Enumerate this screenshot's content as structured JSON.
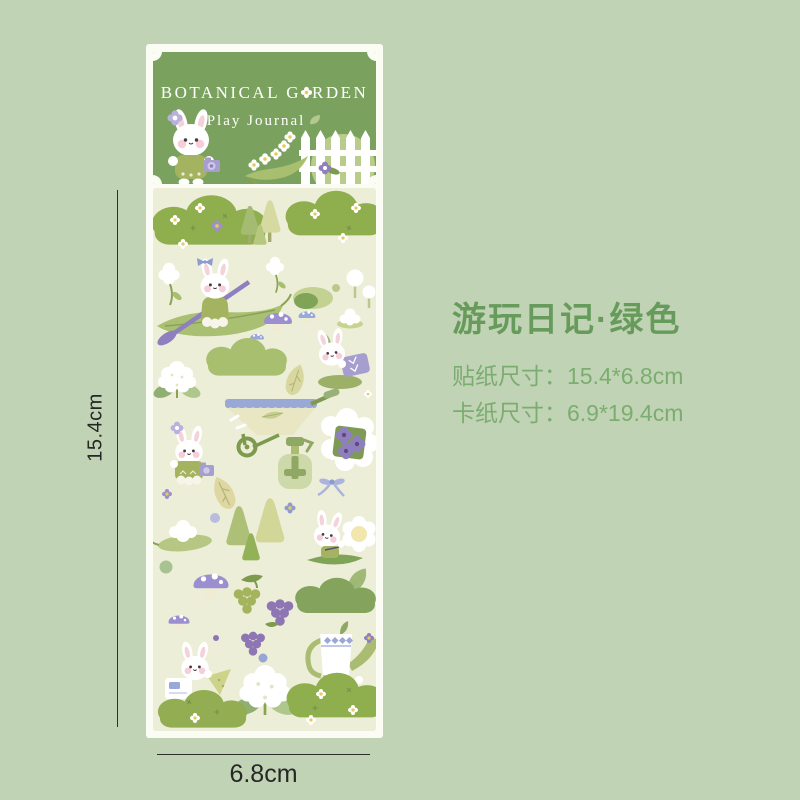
{
  "page": {
    "background_color": "#c0d3b4"
  },
  "card": {
    "header": {
      "title_full": "BOTANICAL GARDEN",
      "title_left": "BOTANICAL G",
      "title_right": "RDEN",
      "subtitle": "Play Journal",
      "background_color": "#7aa25e",
      "text_color": "#ffffff",
      "icons": [
        "flower-icon",
        "leaf-icon",
        "bunny-with-camera-illustration",
        "flower-garland-illustration",
        "picket-fence-illustration"
      ]
    },
    "sheet": {
      "background_color": "#edeed8",
      "stickers": [
        "grass-bush-with-flowers",
        "purple-flower",
        "pine-trees",
        "grass-bush-with-flowers",
        "white-tulip",
        "bunny-rowing-leaf-boat",
        "green-mound",
        "purple-spotted-mushroom",
        "blue-mushrooms",
        "white-flower-on-lilypad",
        "white-round-trees",
        "cauliflower-bouquet",
        "green-hill",
        "leaf",
        "bunny-with-purple-book",
        "wheelbarrow-with-plant",
        "bunny-with-camera",
        "spray-bottle",
        "wrapped-flower-gift-with-ribbon-bow",
        "leaf",
        "purple-flower",
        "white-flower-on-leaf",
        "purple-mushrooms",
        "pine-trees",
        "blue-flower",
        "bunny-with-big-flower",
        "green-cloud-bush",
        "grape-bunches",
        "watering-can",
        "bunny-journaling",
        "cauliflower-bouquet",
        "grass-bush-with-flowers",
        "grass-bush-with-flowers"
      ]
    }
  },
  "dimensions": {
    "height_label": "15.4cm",
    "width_label": "6.8cm"
  },
  "info": {
    "title": "游玩日记·绿色",
    "title_color": "#679b5b",
    "spec_color": "#7cad70",
    "specs": [
      {
        "label": "贴纸尺寸：",
        "value": "15.4*6.8cm"
      },
      {
        "label": "卡纸尺寸：",
        "value": "6.9*19.4cm"
      }
    ]
  }
}
